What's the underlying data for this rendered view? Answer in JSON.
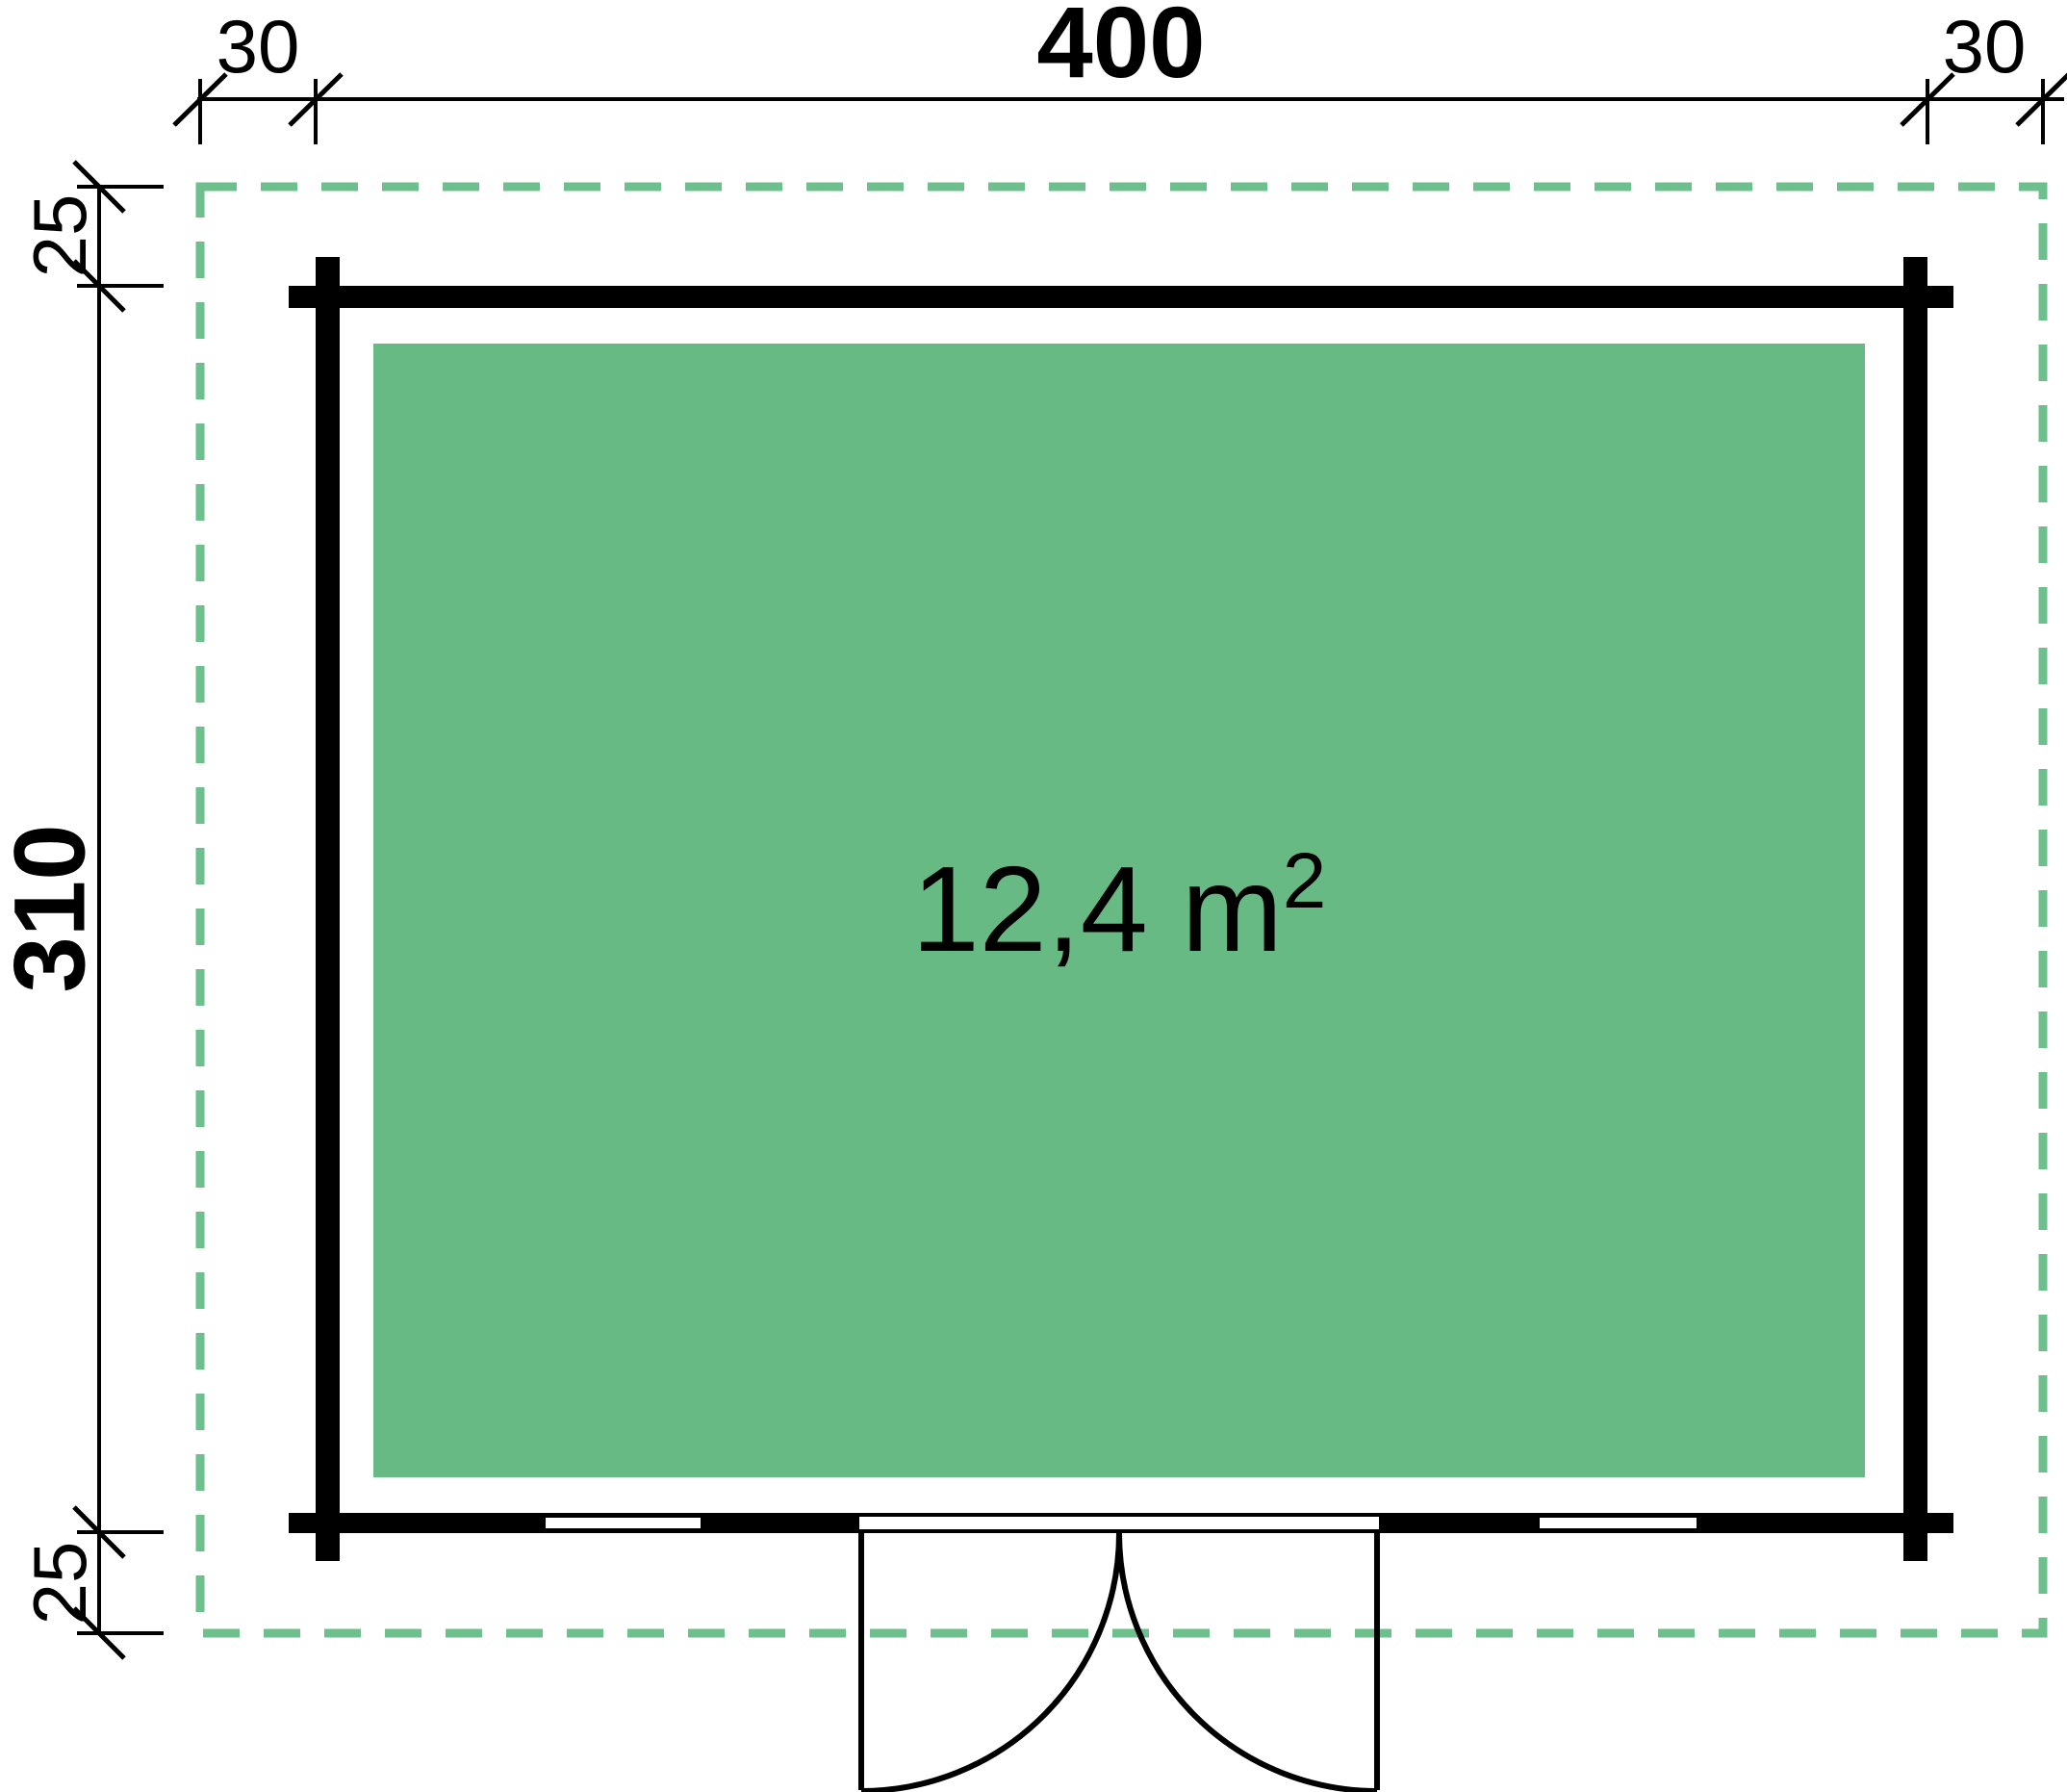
{
  "title": "garden-house floor plan",
  "dimensions": {
    "top": {
      "left_overhang": "30",
      "width": "400",
      "right_overhang": "30"
    },
    "left": {
      "top_overhang": "25",
      "height": "310",
      "bottom_overhang": "25"
    }
  },
  "area": {
    "value": "12,4 m",
    "exponent": "2"
  },
  "colors": {
    "interior_fill": "#68ba84",
    "roof_dash": "#6dbf8b",
    "wall": "#000000",
    "dimension_lines": "#000000",
    "area_text": "#ffffff"
  }
}
